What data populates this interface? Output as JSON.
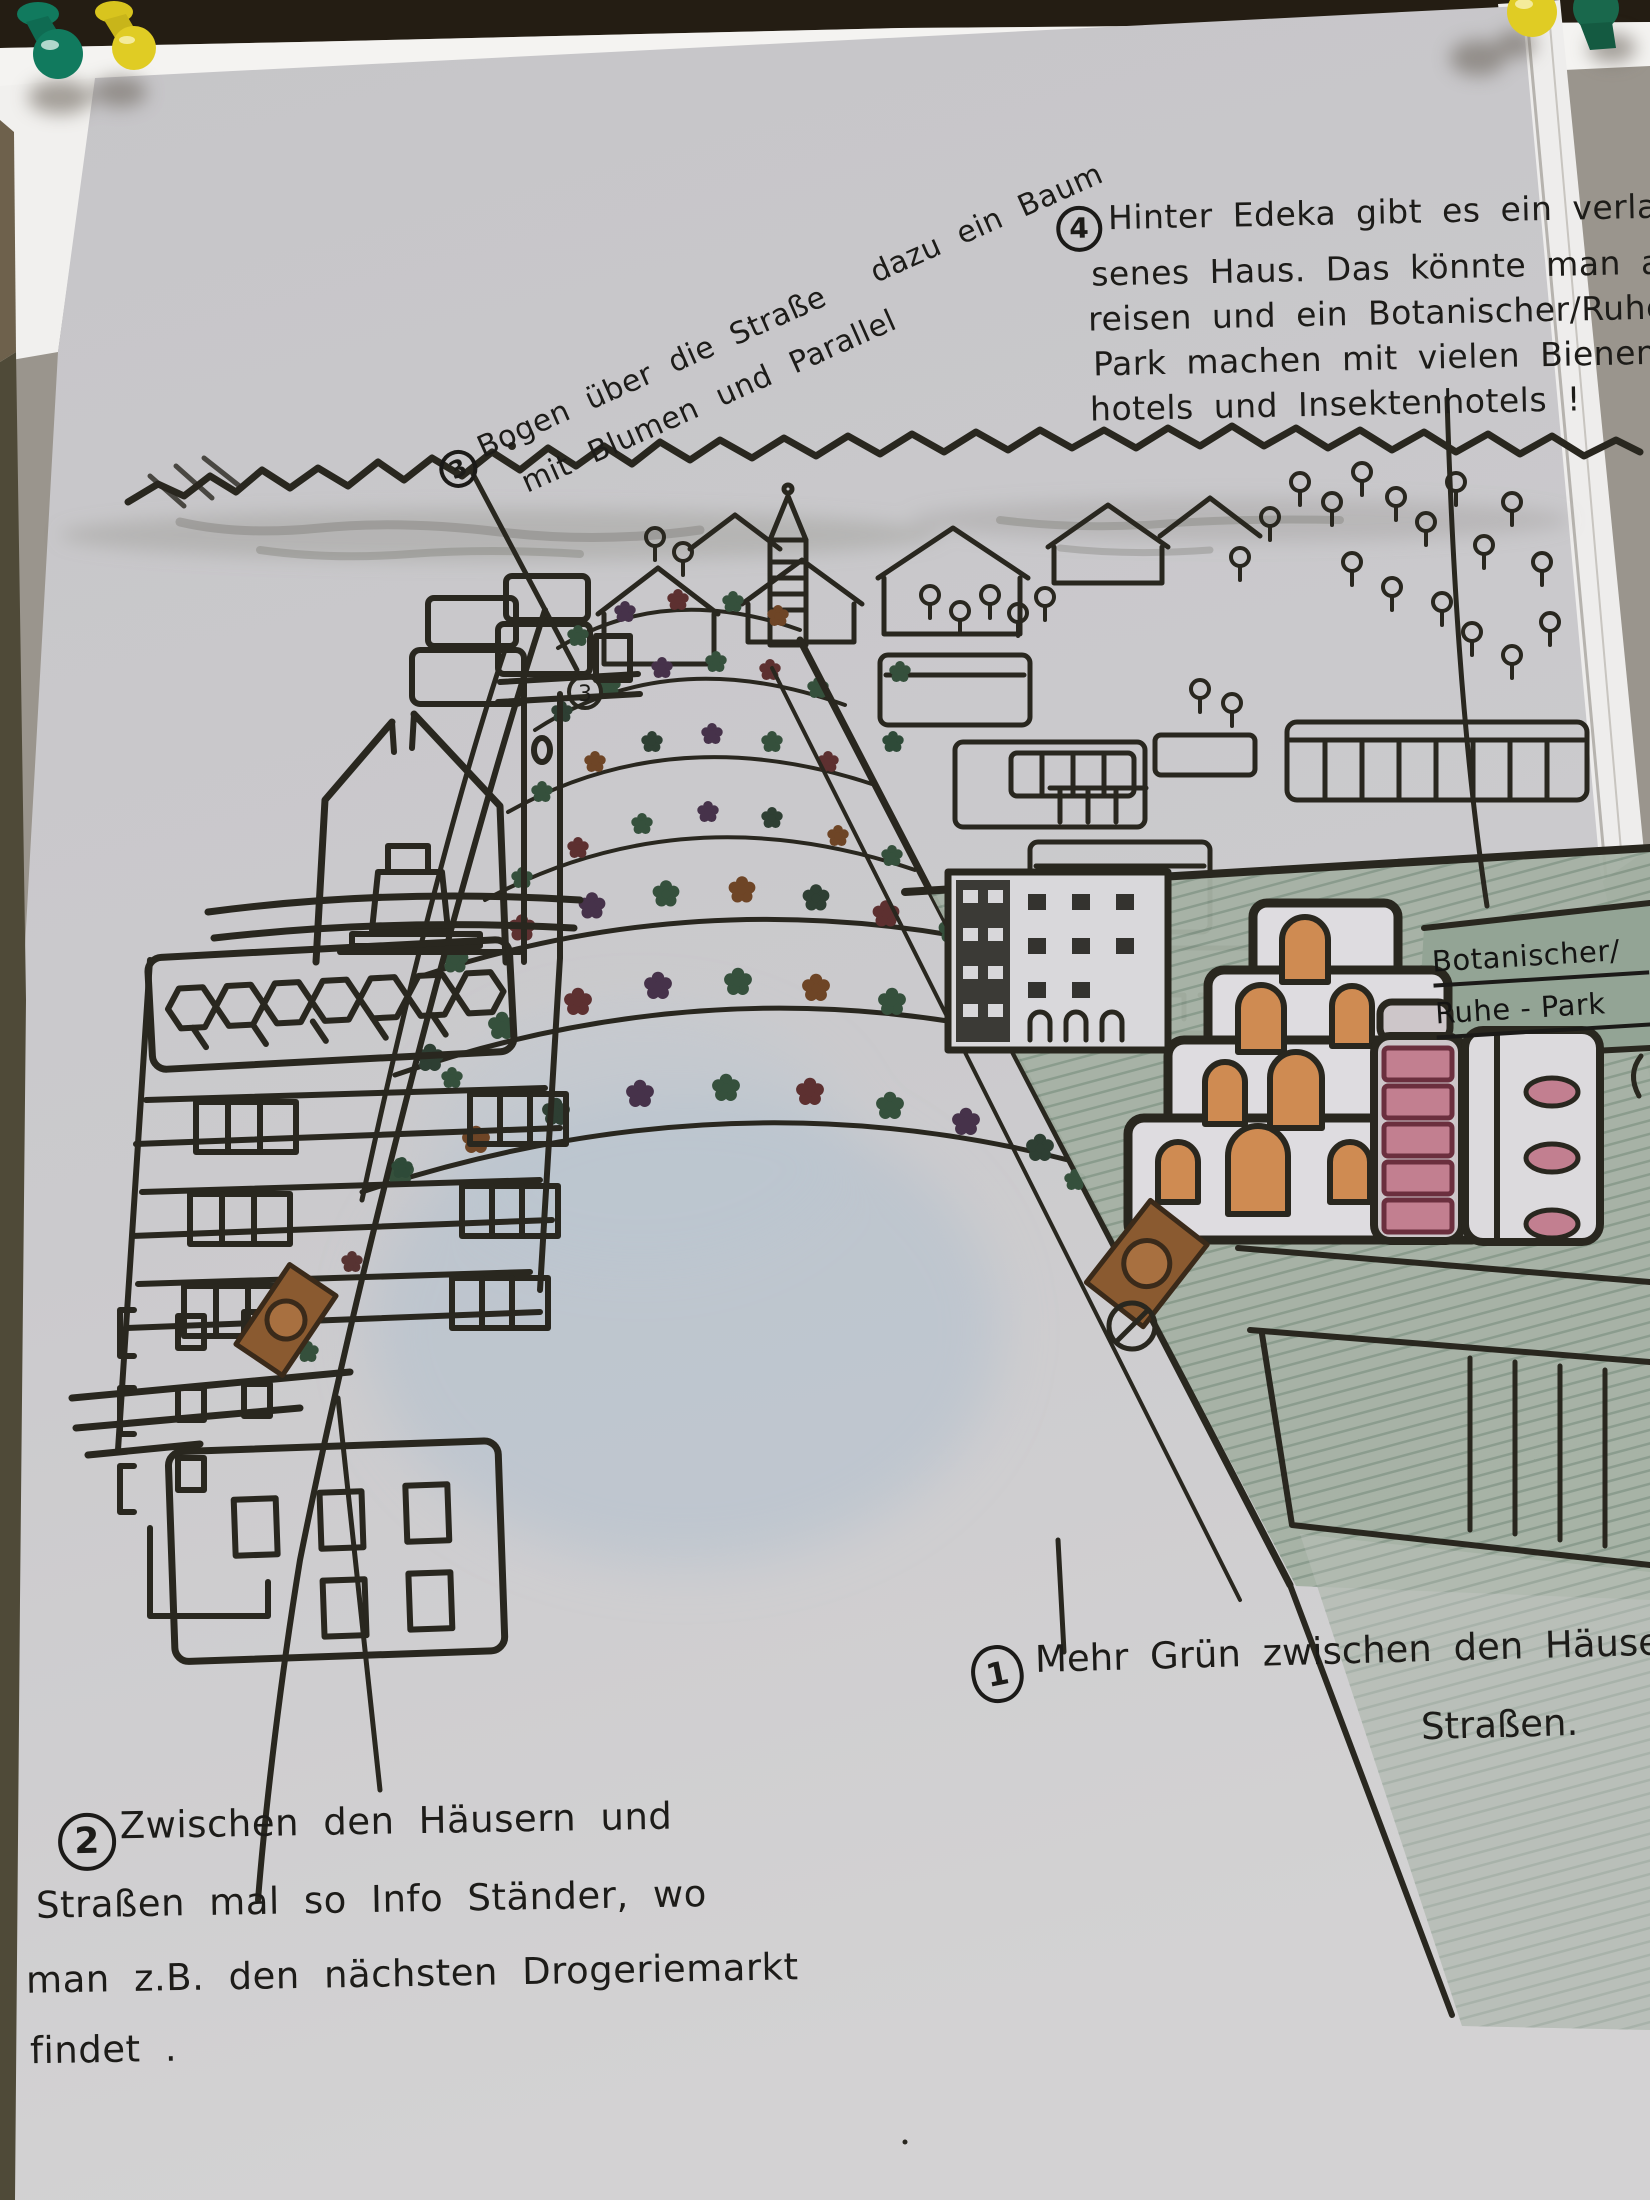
{
  "notes": {
    "n1": {
      "num": "1",
      "t1": "Mehr Grün zwischen den Häusern u",
      "t2": "Straßen."
    },
    "n2": {
      "num": "2",
      "l1": "Zwischen den Häusern und",
      "l2": "Straßen mal so Info Ständer, wo",
      "l3": "man z.B. den nächsten Drogeriemarkt",
      "l4": "findet ."
    },
    "n3": {
      "num": "3",
      "a": "Bogen über die Straße",
      "b": "dazu ein Baum",
      "c": "mit Blumen und Parallel",
      "marker": "3"
    },
    "n4": {
      "num": "4",
      "l1": "Hinter Edeka gibt es ein verla",
      "l2": "senes Haus. Das könnte man ab-",
      "l3": "reisen und ein Botanischer/Ruhe",
      "l4": "Park machen mit vielen Bienen-",
      "l5": "hotels und Insektenhotels !"
    }
  },
  "sign": {
    "l1": "Botanischer/",
    "l2": "Ruhe - Park"
  },
  "icons": {
    "pin_top_left_1": "green-pushpin-icon",
    "pin_top_left_2": "yellow-pushpin-icon",
    "pin_top_right_1": "yellow-pushpin-icon",
    "pin_top_right_2": "dark-green-pushpin-icon"
  },
  "palette": {
    "paper": "#c9c8cb",
    "ink": "#29271f",
    "park_green": "#a5b1a4",
    "orange_window": "#cf8b52",
    "pink_window": "#c27f90",
    "pink_frame": "#6b2f3e",
    "blue_wash": "#b4c2cf",
    "pin_green": "#117a5e",
    "pin_yellow": "#e0cc24",
    "board_dark": "#241d13",
    "backdrop_gray": "#9a958d",
    "sign_brown": "#8a5a30"
  }
}
